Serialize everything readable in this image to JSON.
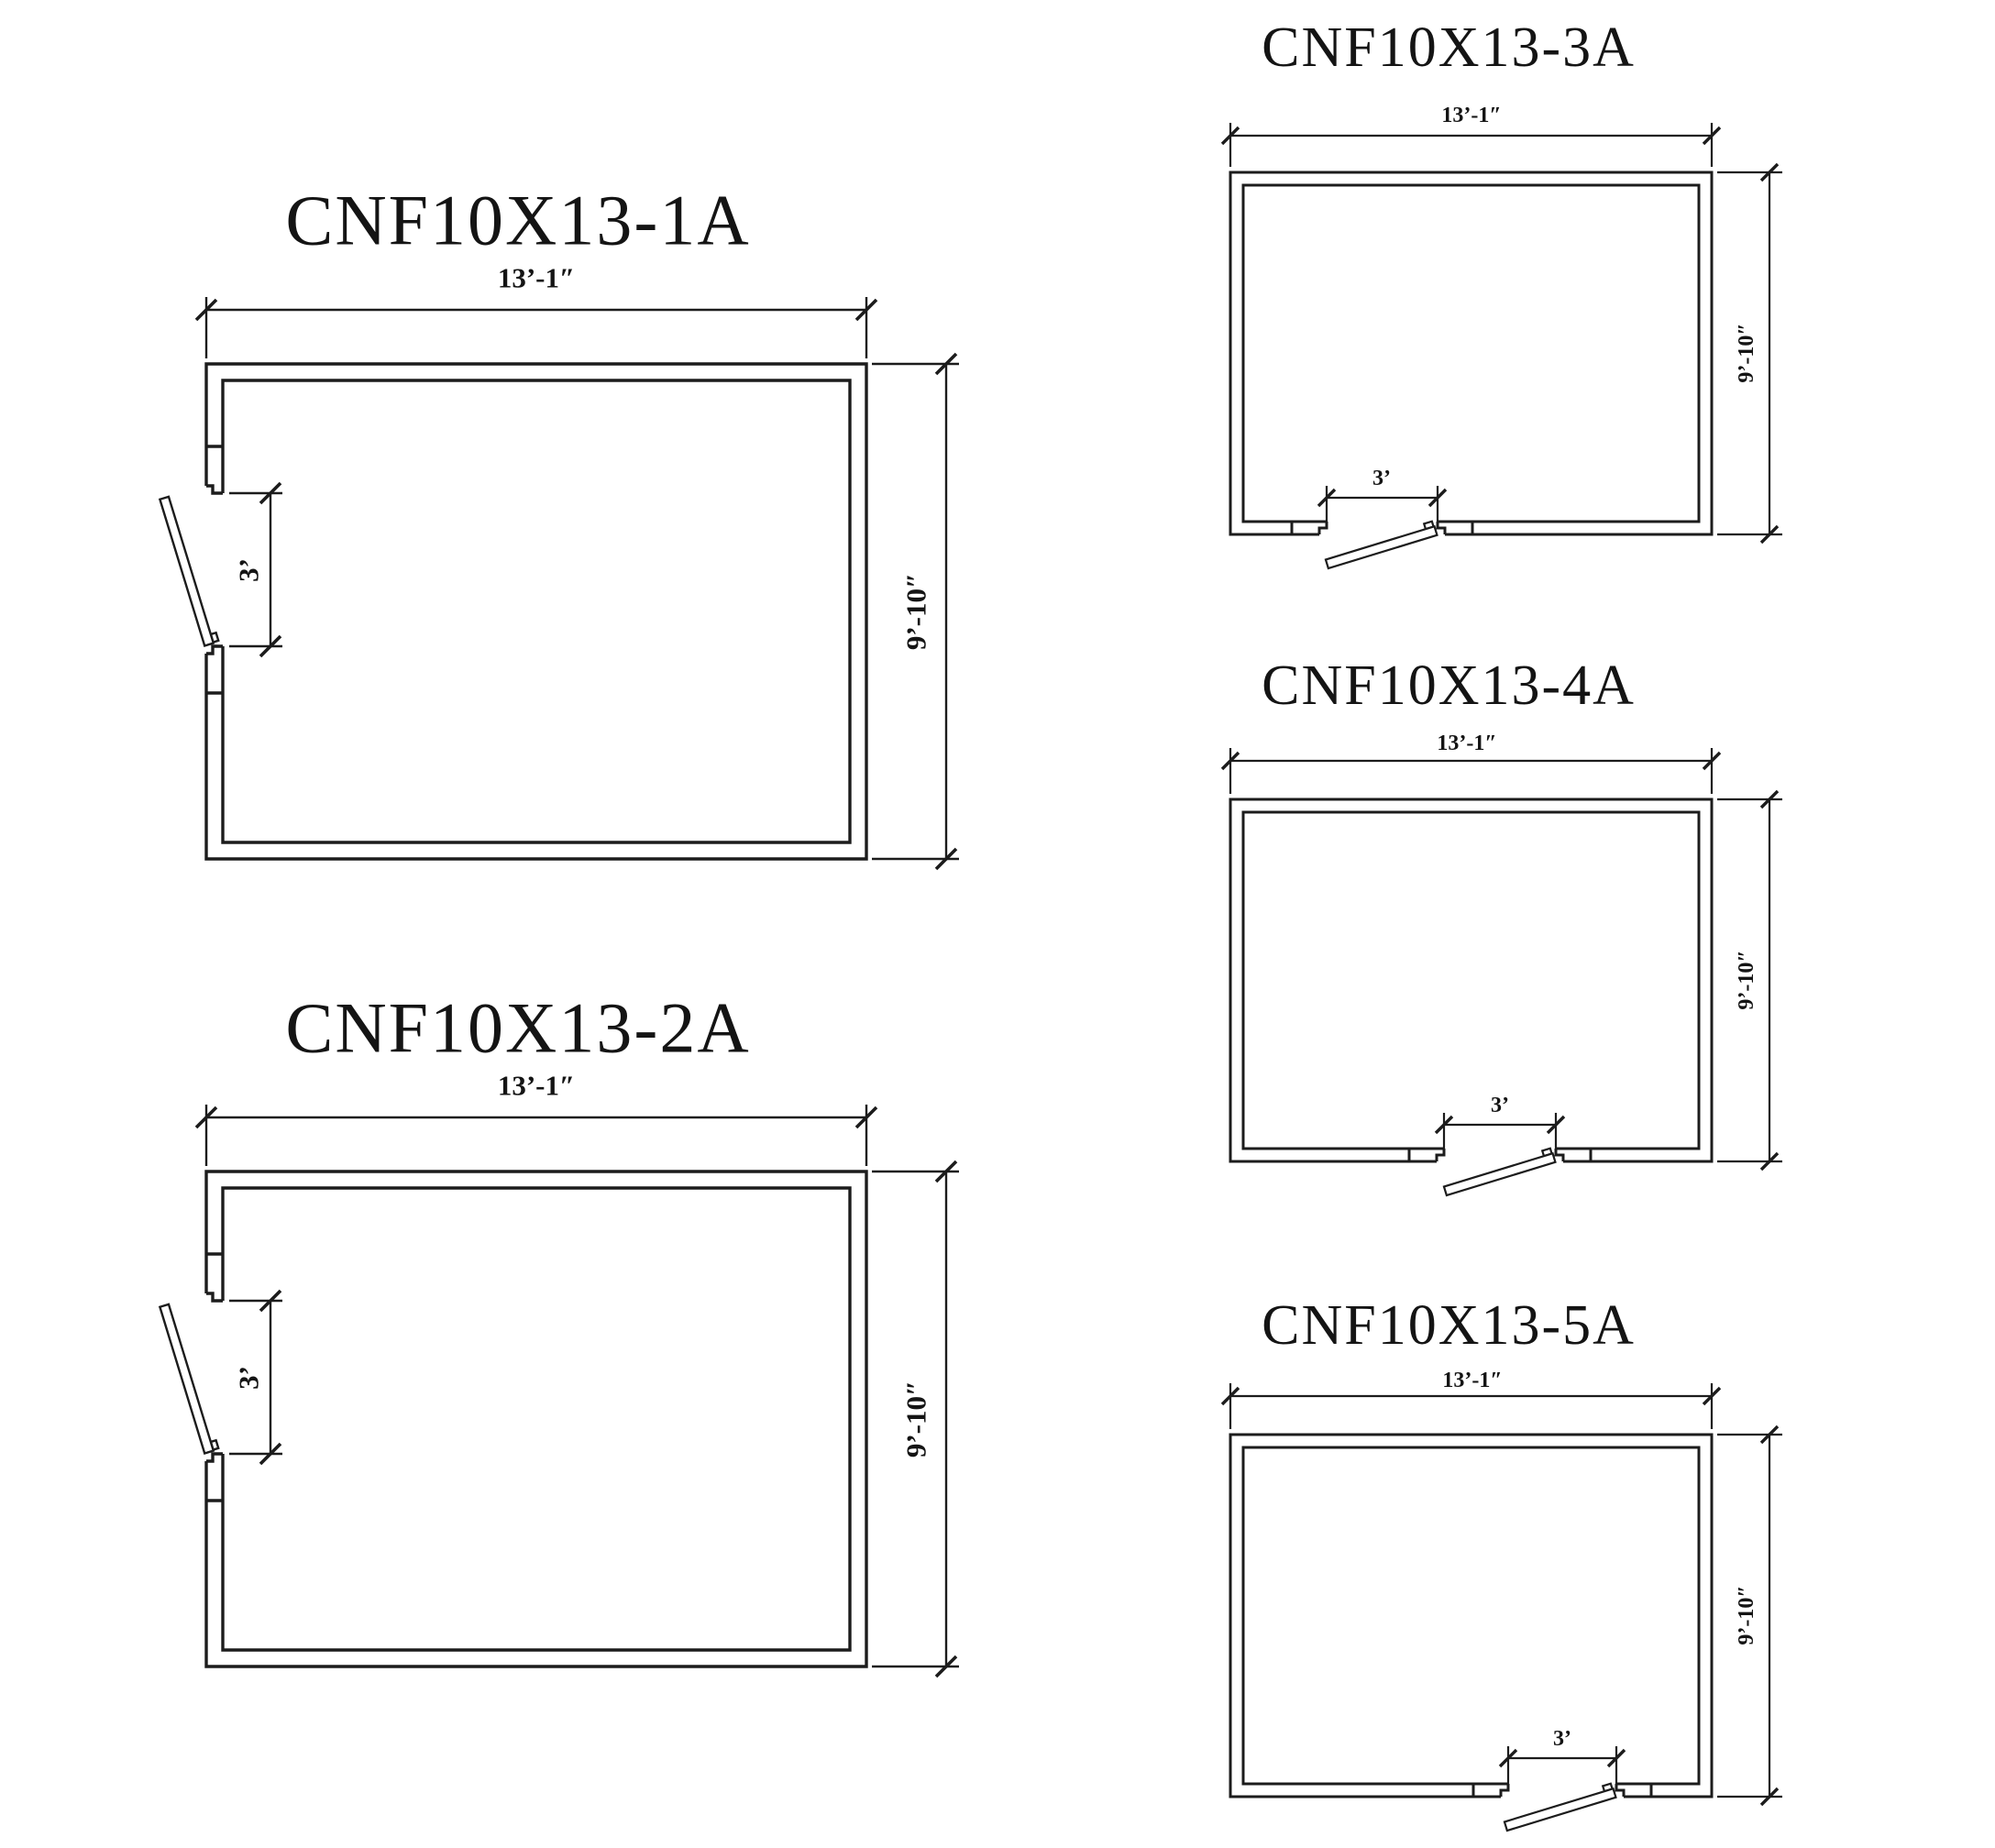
{
  "page": {
    "background": "#ffffff",
    "line_color": "#1c1c1c",
    "text_color": "#141414",
    "drawing_type": "cooler/freezer room floor-plan option sheet",
    "plan_count": 5
  },
  "plans": [
    {
      "id": "1A",
      "title": "CNF10X13-1A",
      "width_label": "13’-1″",
      "height_label": "9’-10″",
      "door_width_label": "3’",
      "door_wall": "left",
      "door_swing": "out-swing"
    },
    {
      "id": "2A",
      "title": "CNF10X13-2A",
      "width_label": "13’-1″",
      "height_label": "9’-10″",
      "door_width_label": "3’",
      "door_wall": "left",
      "door_swing": "out-swing"
    },
    {
      "id": "3A",
      "title": "CNF10X13-3A",
      "width_label": "13’-1″",
      "height_label": "9’-10″",
      "door_width_label": "3’",
      "door_wall": "bottom",
      "door_swing": "out-swing"
    },
    {
      "id": "4A",
      "title": "CNF10X13-4A",
      "width_label": "13’-1″",
      "height_label": "9’-10″",
      "door_width_label": "3’",
      "door_wall": "bottom",
      "door_swing": "out-swing"
    },
    {
      "id": "5A",
      "title": "CNF10X13-5A",
      "width_label": "13’-1″",
      "height_label": "9’-10″",
      "door_width_label": "3’",
      "door_wall": "bottom",
      "door_swing": "out-swing"
    }
  ]
}
